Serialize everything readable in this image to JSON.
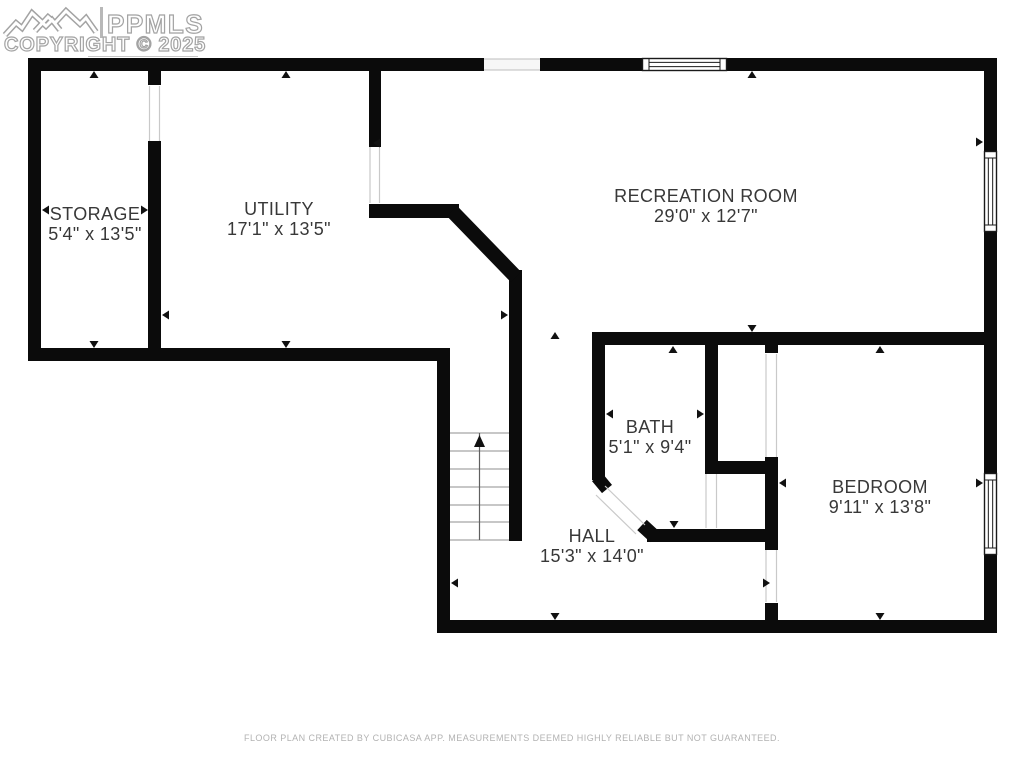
{
  "watermark": {
    "ppmls": "PPMLS",
    "copyright": "COPYRIGHT © 2025"
  },
  "footer": {
    "text": "FLOOR PLAN CREATED BY CUBICASA APP. MEASUREMENTS DEEMED HIGHLY RELIABLE BUT NOT GUARANTEED."
  },
  "rooms": [
    {
      "id": "storage",
      "name": "STORAGE",
      "dims": "5'4\" x 13'5\"",
      "x": 95,
      "y": 204
    },
    {
      "id": "utility",
      "name": "UTILITY",
      "dims": "17'1\" x 13'5\"",
      "x": 279,
      "y": 199
    },
    {
      "id": "recreation-room",
      "name": "RECREATION ROOM",
      "dims": "29'0\" x 12'7\"",
      "x": 706,
      "y": 186
    },
    {
      "id": "bath",
      "name": "BATH",
      "dims": "5'1\" x 9'4\"",
      "x": 650,
      "y": 417
    },
    {
      "id": "bedroom",
      "name": "BEDROOM",
      "dims": "9'11\" x 13'8\"",
      "x": 880,
      "y": 477
    },
    {
      "id": "hall",
      "name": "HALL",
      "dims": "15'3\" x 14'0\"",
      "x": 592,
      "y": 526
    }
  ],
  "colors": {
    "wall": "#0b0b0b",
    "label_text": "#383838",
    "marker": "#111111",
    "opening_line": "#c9c9c9",
    "gap_fill": "#f7f7f7",
    "window_frame": "#1a1a1a",
    "tread_line": "#8f8f8f",
    "stair_center": "#606060",
    "footer_text": "#b2b2b2",
    "watermark_outline": "#a3a3a3"
  },
  "geometry": {
    "walls": [
      [
        28,
        58,
        456,
        13
      ],
      [
        540,
        58,
        102,
        13
      ],
      [
        727,
        58,
        270,
        13
      ],
      [
        28,
        58,
        13,
        302
      ],
      [
        28,
        348,
        422,
        13
      ],
      [
        437,
        348,
        13,
        285
      ],
      [
        437,
        620,
        560,
        13
      ],
      [
        984,
        58,
        13,
        93
      ],
      [
        984,
        232,
        13,
        241
      ],
      [
        984,
        555,
        13,
        78
      ],
      [
        148,
        58,
        13,
        27
      ],
      [
        148,
        141,
        13,
        219
      ],
      [
        369,
        58,
        12,
        89
      ],
      [
        369,
        204,
        90,
        14
      ],
      [
        509,
        270,
        13,
        271
      ],
      [
        592,
        332,
        405,
        13
      ],
      [
        592,
        332,
        13,
        148
      ],
      [
        705,
        332,
        13,
        141
      ],
      [
        705,
        461,
        73,
        13
      ],
      [
        765,
        332,
        13,
        21
      ],
      [
        765,
        457,
        13,
        93
      ],
      [
        765,
        603,
        13,
        30
      ],
      [
        647,
        529,
        131,
        13
      ]
    ],
    "diagonal_walls": [
      [
        452,
        211,
        516,
        277,
        14.5
      ],
      [
        597,
        477,
        607,
        489,
        13
      ],
      [
        642,
        525,
        655,
        537,
        14
      ]
    ],
    "gap_fills": [
      [
        484,
        59,
        56,
        11
      ]
    ],
    "opening_lines": [
      [
        149.5,
        86,
        149.5,
        141
      ],
      [
        159.5,
        86,
        159.5,
        141
      ],
      [
        370,
        147,
        370,
        203
      ],
      [
        379.5,
        147,
        379.5,
        203
      ],
      [
        484,
        59,
        540,
        59
      ],
      [
        484,
        70,
        540,
        70
      ],
      [
        605,
        486,
        645,
        525
      ],
      [
        596,
        495,
        636,
        534
      ],
      [
        706,
        474,
        706,
        528
      ],
      [
        716.5,
        474,
        716.5,
        528
      ],
      [
        766,
        354,
        766,
        457
      ],
      [
        776.5,
        354,
        776.5,
        457
      ],
      [
        766,
        550,
        766,
        602
      ],
      [
        776.5,
        550,
        776.5,
        602
      ]
    ],
    "windows": [
      {
        "x": 642,
        "y": 58,
        "w": 85,
        "h": 13,
        "o": "h"
      },
      {
        "x": 984,
        "y": 151,
        "w": 13,
        "h": 81,
        "o": "v"
      },
      {
        "x": 984,
        "y": 473,
        "w": 13,
        "h": 82,
        "o": "v"
      }
    ],
    "stairs": {
      "x": 450,
      "w": 59,
      "tread_ys": [
        433,
        451,
        469,
        487,
        505,
        522,
        540
      ],
      "center_x": 479.5,
      "top": 433,
      "bottom": 540,
      "arrow": {
        "tip_x": 479.5,
        "tip_y": 435,
        "base_y": 447,
        "half_w": 5.5
      }
    },
    "markers": [
      {
        "x": 94,
        "y": 71,
        "d": "up"
      },
      {
        "x": 286,
        "y": 71,
        "d": "up"
      },
      {
        "x": 752,
        "y": 71,
        "d": "up"
      },
      {
        "x": 94,
        "y": 348,
        "d": "down"
      },
      {
        "x": 286,
        "y": 348,
        "d": "down"
      },
      {
        "x": 42,
        "y": 210,
        "d": "left"
      },
      {
        "x": 148,
        "y": 210,
        "d": "right"
      },
      {
        "x": 162,
        "y": 315,
        "d": "left"
      },
      {
        "x": 373,
        "y": 143,
        "d": "left"
      },
      {
        "x": 508,
        "y": 315,
        "d": "right"
      },
      {
        "x": 555,
        "y": 332,
        "d": "up"
      },
      {
        "x": 673,
        "y": 346,
        "d": "up"
      },
      {
        "x": 752,
        "y": 332,
        "d": "down"
      },
      {
        "x": 606,
        "y": 414,
        "d": "left"
      },
      {
        "x": 704,
        "y": 414,
        "d": "right"
      },
      {
        "x": 674,
        "y": 528,
        "d": "down"
      },
      {
        "x": 770,
        "y": 583,
        "d": "right"
      },
      {
        "x": 779,
        "y": 483,
        "d": "left"
      },
      {
        "x": 880,
        "y": 346,
        "d": "up"
      },
      {
        "x": 880,
        "y": 620,
        "d": "down"
      },
      {
        "x": 983,
        "y": 483,
        "d": "right"
      },
      {
        "x": 983,
        "y": 142,
        "d": "right"
      },
      {
        "x": 451,
        "y": 583,
        "d": "left"
      },
      {
        "x": 555,
        "y": 620,
        "d": "down"
      }
    ]
  }
}
